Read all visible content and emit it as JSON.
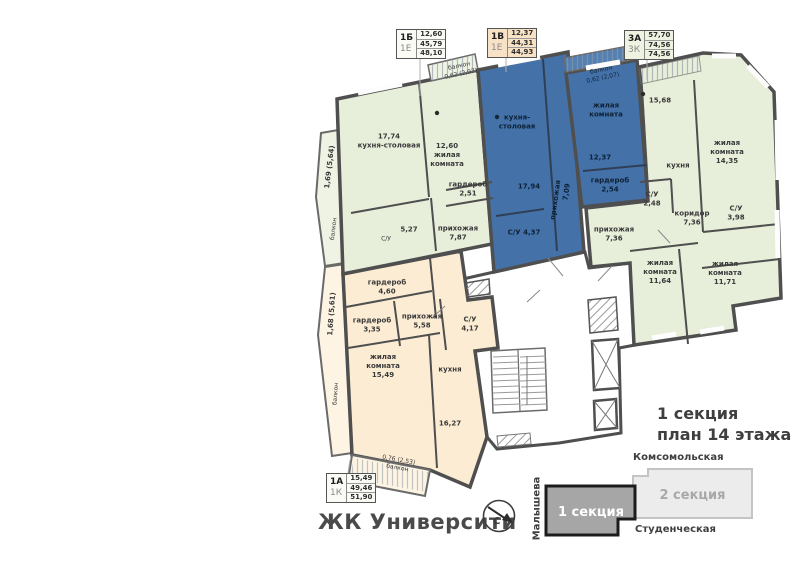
{
  "brand": "ЖК Университи",
  "title": {
    "line1": "1 секция",
    "line2": "план 14 этажа"
  },
  "legend": {
    "b1": {
      "type": "1Б",
      "cat": "1Е",
      "values": [
        "12,60",
        "45,79",
        "48,10"
      ]
    },
    "b2": {
      "type": "1В",
      "cat": "1Е",
      "values": [
        "12,37",
        "44,31",
        "44,93"
      ]
    },
    "b3": {
      "type": "3А",
      "cat": "3К",
      "values": [
        "57,70",
        "74,56",
        "74,56"
      ]
    },
    "b4": {
      "type": "1А",
      "cat": "1К",
      "values": [
        "15,49",
        "49,46",
        "51,90"
      ]
    }
  },
  "sitemap": {
    "street_top": "Комсомольская",
    "street_bottom": "Студенческая",
    "street_left": "Малышева",
    "section1": "1 секция",
    "section2": "2 секция"
  },
  "compass": {
    "north": "С"
  },
  "colors": {
    "green": "#e7eeda",
    "green_light": "#eef3e3",
    "blue": "#4472a8",
    "blue_light": "#5580b2",
    "beige": "#fcecd4",
    "beige_light": "#fdf4e4",
    "wall": "#4f4f4f",
    "core": "#ffffff"
  },
  "plan": {
    "labels": [
      {
        "id": "1b-balcony-top",
        "lines": [
          "балкон",
          "0,62 (2,07)"
        ],
        "x": 460,
        "y": 70,
        "rot": -12,
        "cls": "sm"
      },
      {
        "id": "1b-kitchen",
        "lines": [
          "17,74",
          "кухня-столовая"
        ],
        "x": 389,
        "y": 141
      },
      {
        "id": "1b-living",
        "lines": [
          "12,60",
          "жилая",
          "комната"
        ],
        "x": 447,
        "y": 155
      },
      {
        "id": "1b-wardrobe",
        "lines": [
          "гардероб",
          "2,51"
        ],
        "x": 468,
        "y": 189
      },
      {
        "id": "1b-hall",
        "lines": [
          "прихожая",
          "7,87"
        ],
        "x": 458,
        "y": 233
      },
      {
        "id": "1b-bath-value",
        "lines": [
          "5,27"
        ],
        "x": 409,
        "y": 230
      },
      {
        "id": "1b-bath",
        "lines": [
          "С/У"
        ],
        "x": 386,
        "y": 239,
        "cls": "sm"
      },
      {
        "id": "1b-balcony-left-value",
        "lines": [
          "1,69 (5,64)"
        ],
        "x": 330,
        "y": 167,
        "rot": -83
      },
      {
        "id": "1b-balcony-left",
        "lines": [
          "балкон"
        ],
        "x": 334,
        "y": 229,
        "rot": -83,
        "cls": "sm"
      },
      {
        "id": "1v-balcony-top",
        "lines": [
          "балкон",
          "0,62 (2,07)"
        ],
        "x": 602,
        "y": 74,
        "rot": -12,
        "cls": "sm blue"
      },
      {
        "id": "1v-kitchen",
        "lines": [
          "кухня-",
          "столовая"
        ],
        "x": 517,
        "y": 122,
        "cls": "blue"
      },
      {
        "id": "1v-kitchen-value",
        "lines": [
          "17,94"
        ],
        "x": 529,
        "y": 187,
        "cls": "blue"
      },
      {
        "id": "1v-living",
        "lines": [
          "жилая",
          "комната"
        ],
        "x": 606,
        "y": 110,
        "cls": "blue"
      },
      {
        "id": "1v-living-value",
        "lines": [
          "12,37"
        ],
        "x": 600,
        "y": 158,
        "cls": "blue"
      },
      {
        "id": "1v-wardrobe",
        "lines": [
          "гардероб",
          "2,54"
        ],
        "x": 610,
        "y": 185,
        "cls": "blue"
      },
      {
        "id": "1v-hall",
        "lines": [
          "прихожая"
        ],
        "x": 556,
        "y": 200,
        "rot": -82,
        "cls": "blue"
      },
      {
        "id": "1v-hall-value",
        "lines": [
          "7,09"
        ],
        "x": 567,
        "y": 192,
        "rot": -82,
        "cls": "blue"
      },
      {
        "id": "1v-bath",
        "lines": [
          "С/У 4,37"
        ],
        "x": 524,
        "y": 233,
        "cls": "blue"
      },
      {
        "id": "3a-kitchen-value",
        "lines": [
          "15,68"
        ],
        "x": 660,
        "y": 101
      },
      {
        "id": "3a-kitchen",
        "lines": [
          "кухня"
        ],
        "x": 678,
        "y": 166
      },
      {
        "id": "3a-living1",
        "lines": [
          "жилая",
          "комната",
          "14,35"
        ],
        "x": 727,
        "y": 152
      },
      {
        "id": "3a-bath1",
        "lines": [
          "С/У",
          "2,48"
        ],
        "x": 652,
        "y": 199
      },
      {
        "id": "3a-corridor",
        "lines": [
          "коридор",
          "7,36"
        ],
        "x": 692,
        "y": 218
      },
      {
        "id": "3a-bath2",
        "lines": [
          "С/У",
          "3,98"
        ],
        "x": 736,
        "y": 213
      },
      {
        "id": "3a-hall",
        "lines": [
          "прихожая",
          "7,36"
        ],
        "x": 614,
        "y": 234
      },
      {
        "id": "3a-living2",
        "lines": [
          "жилая",
          "комната",
          "11,64"
        ],
        "x": 660,
        "y": 272
      },
      {
        "id": "3a-living3",
        "lines": [
          "жилая",
          "комната",
          "11,71"
        ],
        "x": 725,
        "y": 273
      },
      {
        "id": "1a-wardrobe1",
        "lines": [
          "гардероб",
          "4,60"
        ],
        "x": 387,
        "y": 287
      },
      {
        "id": "1a-wardrobe2",
        "lines": [
          "гардероб",
          "3,35"
        ],
        "x": 372,
        "y": 325
      },
      {
        "id": "1a-hall",
        "lines": [
          "прихожая",
          "5,58"
        ],
        "x": 422,
        "y": 321
      },
      {
        "id": "1a-bath",
        "lines": [
          "С/У",
          "4,17"
        ],
        "x": 470,
        "y": 324
      },
      {
        "id": "1a-living",
        "lines": [
          "жилая",
          "комната",
          "15,49"
        ],
        "x": 383,
        "y": 366
      },
      {
        "id": "1a-kitchen",
        "lines": [
          "кухня"
        ],
        "x": 450,
        "y": 370
      },
      {
        "id": "1a-kitchen-value",
        "lines": [
          "16,27"
        ],
        "x": 450,
        "y": 424
      },
      {
        "id": "1a-balcony-bottom",
        "lines": [
          "0,76 (2,53)",
          "балкон"
        ],
        "x": 398,
        "y": 464,
        "rot": 10,
        "cls": "sm"
      },
      {
        "id": "1a-balcony-left-value",
        "lines": [
          "1,68 (5,61)"
        ],
        "x": 332,
        "y": 314,
        "rot": -86
      },
      {
        "id": "1a-balcony-left",
        "lines": [
          "балкон"
        ],
        "x": 336,
        "y": 394,
        "rot": -86,
        "cls": "sm"
      }
    ]
  }
}
